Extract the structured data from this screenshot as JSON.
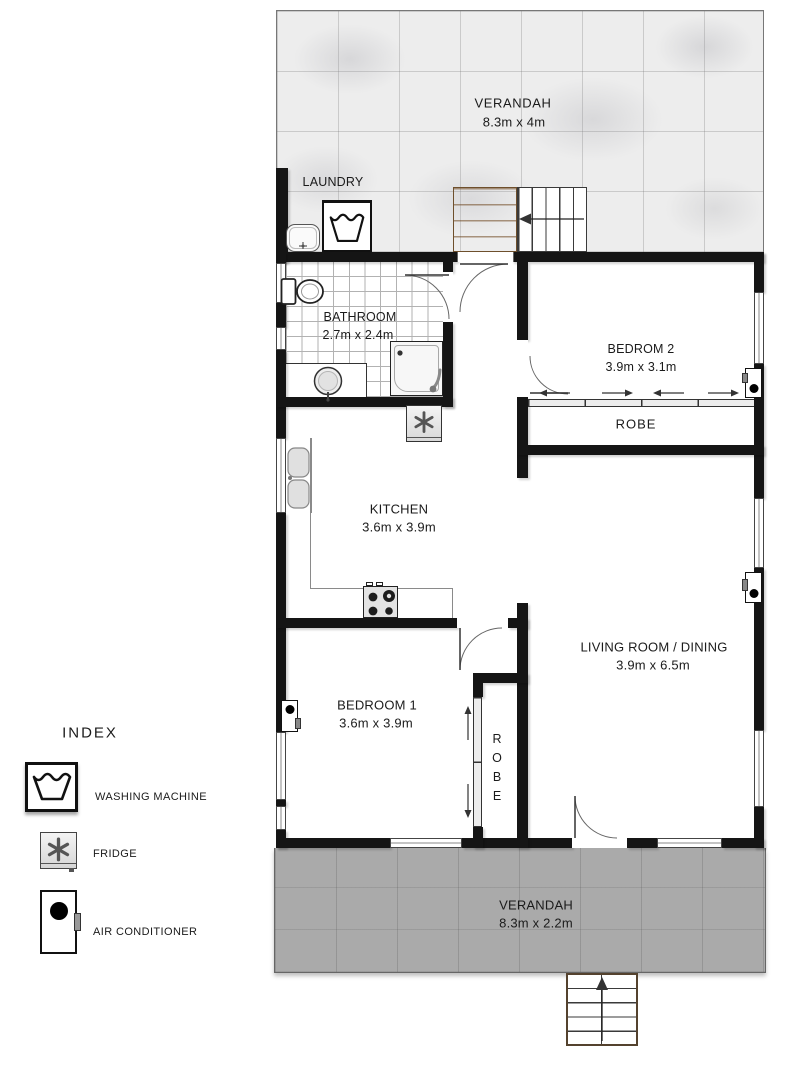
{
  "legend": {
    "title": "INDEX",
    "items": [
      {
        "icon": "washing-machine-icon",
        "label": "WASHING MACHINE"
      },
      {
        "icon": "fridge-icon",
        "label": "FRIDGE"
      },
      {
        "icon": "air-conditioner-icon",
        "label": "AIR CONDITIONER"
      }
    ]
  },
  "rooms": {
    "verandah_top": {
      "name": "VERANDAH",
      "dims": "8.3m x 4m"
    },
    "laundry": {
      "name": "LAUNDRY"
    },
    "bathroom": {
      "name": "BATHROOM",
      "dims": "2.7m x 2.4m"
    },
    "bedroom2": {
      "name": "BEDROM 2",
      "dims": "3.9m x 3.1m"
    },
    "robe_bedroom2": {
      "name": "ROBE"
    },
    "kitchen": {
      "name": "KITCHEN",
      "dims": "3.6m x 3.9m"
    },
    "living": {
      "name": "LIVING ROOM / DINING",
      "dims": "3.9m x 6.5m"
    },
    "bedroom1": {
      "name": "BEDROOM 1",
      "dims": "3.6m x 3.9m"
    },
    "robe_bedroom1": {
      "name": "ROBE"
    },
    "verandah_bottom": {
      "name": "VERANDAH",
      "dims": "8.3m x 2.2m"
    }
  },
  "colors": {
    "wall": "#151515",
    "verandah_top_floor": "#ededed",
    "verandah_bottom_floor": "#aaaaaa",
    "wood_landing": "#b5804f",
    "text": "#1b1b1b"
  }
}
